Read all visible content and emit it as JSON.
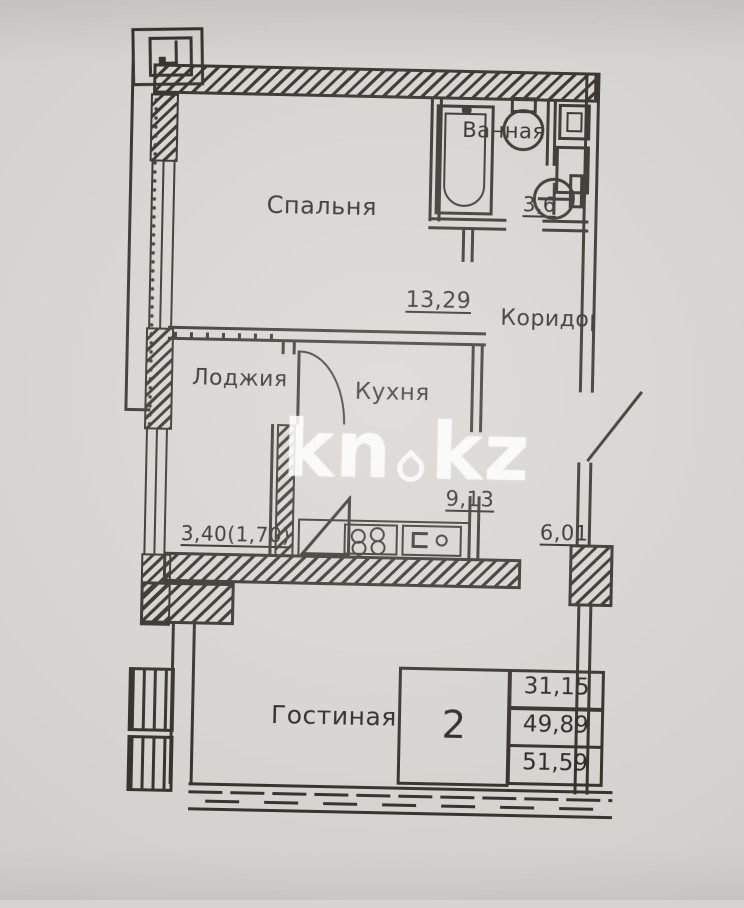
{
  "colors": {
    "paper": "#d6d4d0",
    "ink": "#37342e",
    "watermark": "rgba(255,255,255,0.78)"
  },
  "watermark": {
    "left": "kn",
    "right": "kz"
  },
  "rooms": {
    "bedroom": {
      "label": "Спальня",
      "area": "13,29"
    },
    "bathroom": {
      "label": "Ванная",
      "area": "3,6"
    },
    "corridor": {
      "label": "Коридор",
      "area": "6,01"
    },
    "loggia": {
      "label": "Лоджия",
      "area": "3,40(1,70)"
    },
    "kitchen": {
      "label": "Кухня",
      "area": "9,13"
    },
    "living": {
      "label": "Гостиная"
    }
  },
  "stamp": {
    "rooms_count": "2",
    "living_area": "31,15",
    "total_area": "49,89",
    "total_with_loggia": "51,59"
  }
}
